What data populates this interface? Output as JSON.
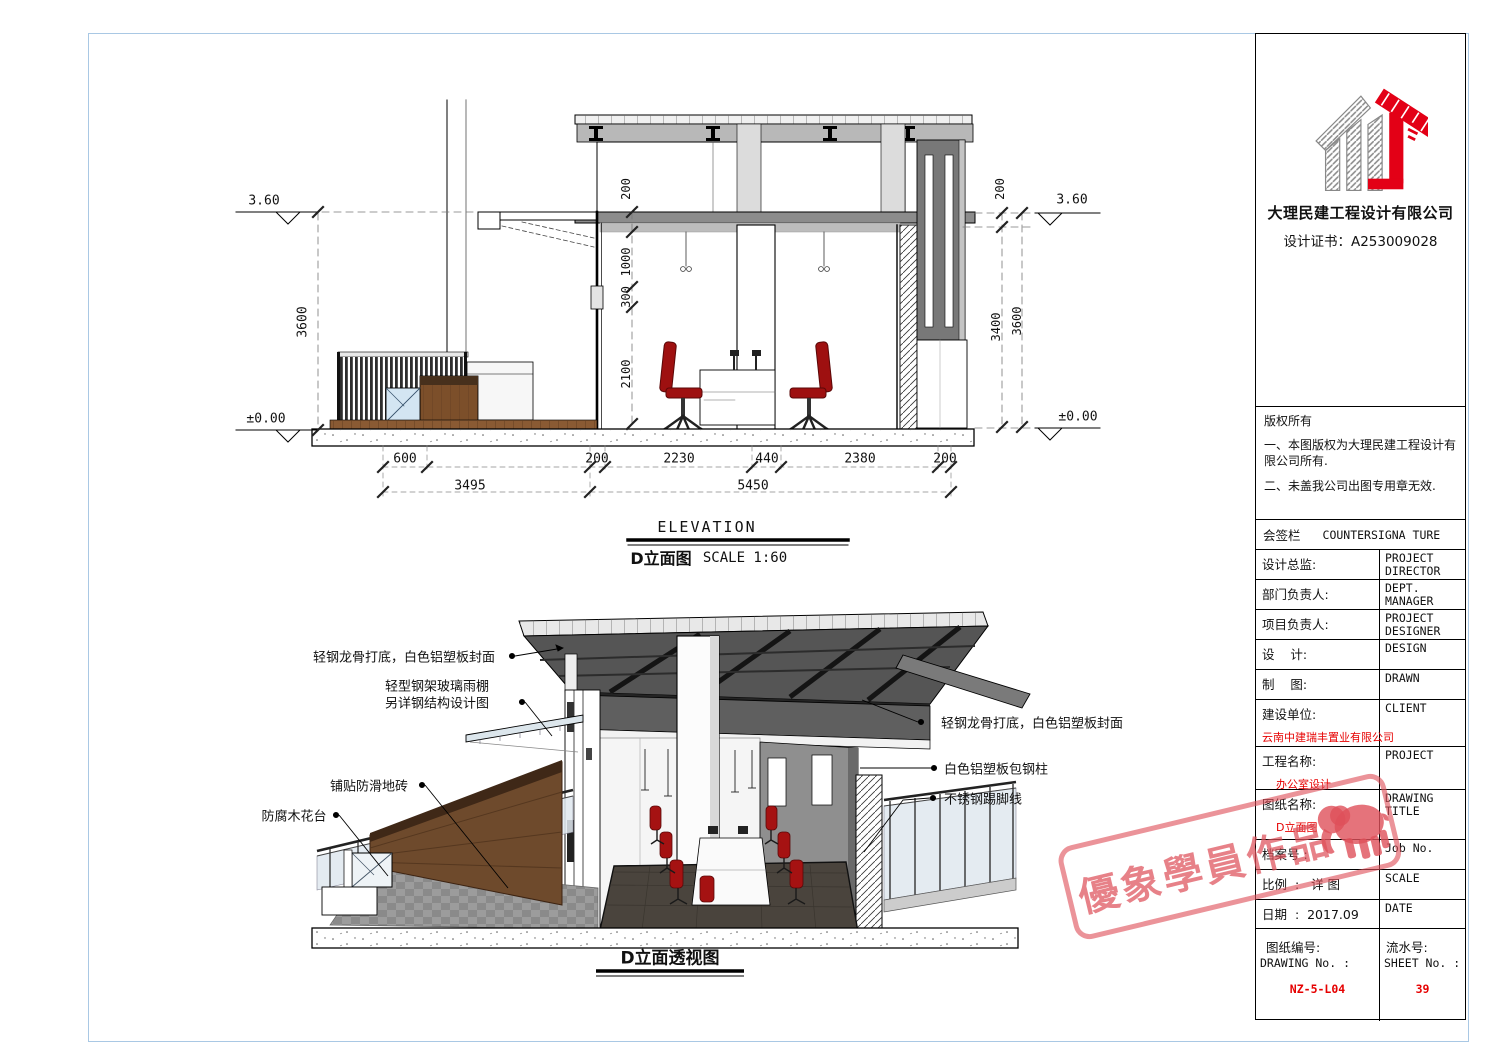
{
  "elev": {
    "title_en": "ELEVATION",
    "title_cn": "D立面图",
    "scale": "SCALE 1:60",
    "lv_top": "3.60",
    "lv_gnd": "±0.00",
    "d3600_l": "3600",
    "d200_i": "200",
    "d1000": "1000",
    "d300": "300",
    "d2100": "2100",
    "d200_r": "200",
    "d3400": "3400",
    "d3600_r": "3600",
    "c600": "600",
    "c200a": "200",
    "c2230": "2230",
    "c440": "440",
    "c2380": "2380",
    "c200b": "200",
    "t3495": "3495",
    "t5450": "5450"
  },
  "persp": {
    "title": "D立面透视图",
    "lbl_roof_left": "轻钢龙骨打底，白色铝塑板封面",
    "lbl_canopy_1": "轻型钢架玻璃雨棚",
    "lbl_canopy_2": "另详钢结构设计图",
    "lbl_floor": "铺贴防滑地砖",
    "lbl_planter": "防腐木花台",
    "lbl_roof_right": "轻钢龙骨打底，白色铝塑板封面",
    "lbl_column": "白色铝塑板包钢柱",
    "lbl_skirting": "不锈钢踢脚线"
  },
  "titleblock": {
    "company": "大理民建工程设计有限公司",
    "certificate": "设计证书：A253009028",
    "copyright_title": "版权所有",
    "copyright_1": "一、本图版权为大理民建工程设计有限公司所有.",
    "copyright_2": "二、未盖我公司出图专用章无效.",
    "countersign_cn": "会签栏",
    "countersign_en": "COUNTERSIGNA TURE",
    "rows": [
      {
        "cn": "设计总监:",
        "en": "PROJECT DIRECTOR"
      },
      {
        "cn": "部门负责人:",
        "en": "DEPT. MANAGER"
      },
      {
        "cn": "项目负责人:",
        "en": "PROJECT DESIGNER"
      },
      {
        "cn": "设    计:",
        "en": "DESIGN"
      },
      {
        "cn": "制    图:",
        "en": "DRAWN"
      },
      {
        "cn": "建设单位:",
        "en": "CLIENT",
        "red": "云南中建瑞丰置业有限公司"
      },
      {
        "cn": "工程名称:",
        "en": "PROJECT",
        "red": "办公室设计"
      },
      {
        "cn": "图纸名称:",
        "en": "DRAWING TITLE",
        "red": "D立面图"
      },
      {
        "cn": "档案号 :",
        "en": "Job  No."
      },
      {
        "cn": "比例  :   详 图",
        "en": "SCALE"
      },
      {
        "cn": "日期  :  2017.09",
        "en": "DATE"
      }
    ],
    "dwgno_cn": "图纸编号:",
    "dwgno_en": "DRAWING No. :",
    "dwgno_val": "NZ-5-L04",
    "sheetno_cn": "流水号:",
    "sheetno_en": "SHEET No. :",
    "sheetno_val": "39"
  },
  "stamp": {
    "text": "優象學員作品"
  },
  "colors": {
    "red_text": "#e60000",
    "stamp_pink": "#de505a",
    "sheet_border": "#a9c8e4",
    "logo_red": "#e30016"
  }
}
